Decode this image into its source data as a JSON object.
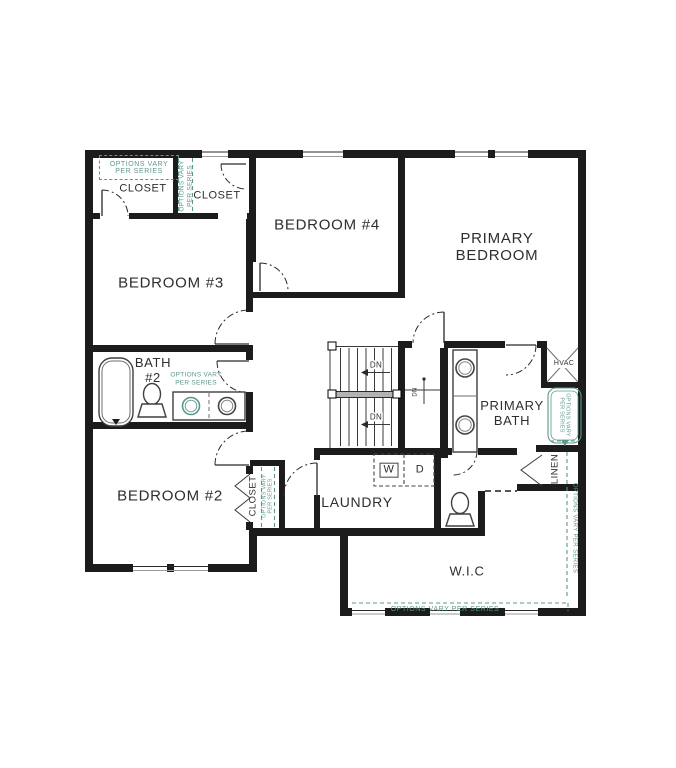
{
  "labels": {
    "closet_left": "CLOSET",
    "closet_right": "CLOSET",
    "bedroom4": "BEDROOM #4",
    "primary_bedroom": [
      "PRIMARY",
      "BEDROOM"
    ],
    "bedroom3": "BEDROOM #3",
    "bath2": [
      "BATH",
      "#2"
    ],
    "bedroom2": "BEDROOM #2",
    "closet2": "CLOSET",
    "laundry": "LAUNDRY",
    "primary_bath": [
      "PRIMARY",
      "BATH"
    ],
    "wic": "W.I.C",
    "linen": "LINEN",
    "hvac": "HVAC",
    "dn": "DN",
    "washer": "W",
    "dryer": "D"
  },
  "annotations": {
    "line1": "OPTIONS VARY",
    "line2": "PER SERIES",
    "full": "OPTIONS VARY PER SERIES"
  },
  "colors": {
    "wall": "#1c1c1c",
    "teal": "#5c978d",
    "text": "#2e2e2e"
  }
}
